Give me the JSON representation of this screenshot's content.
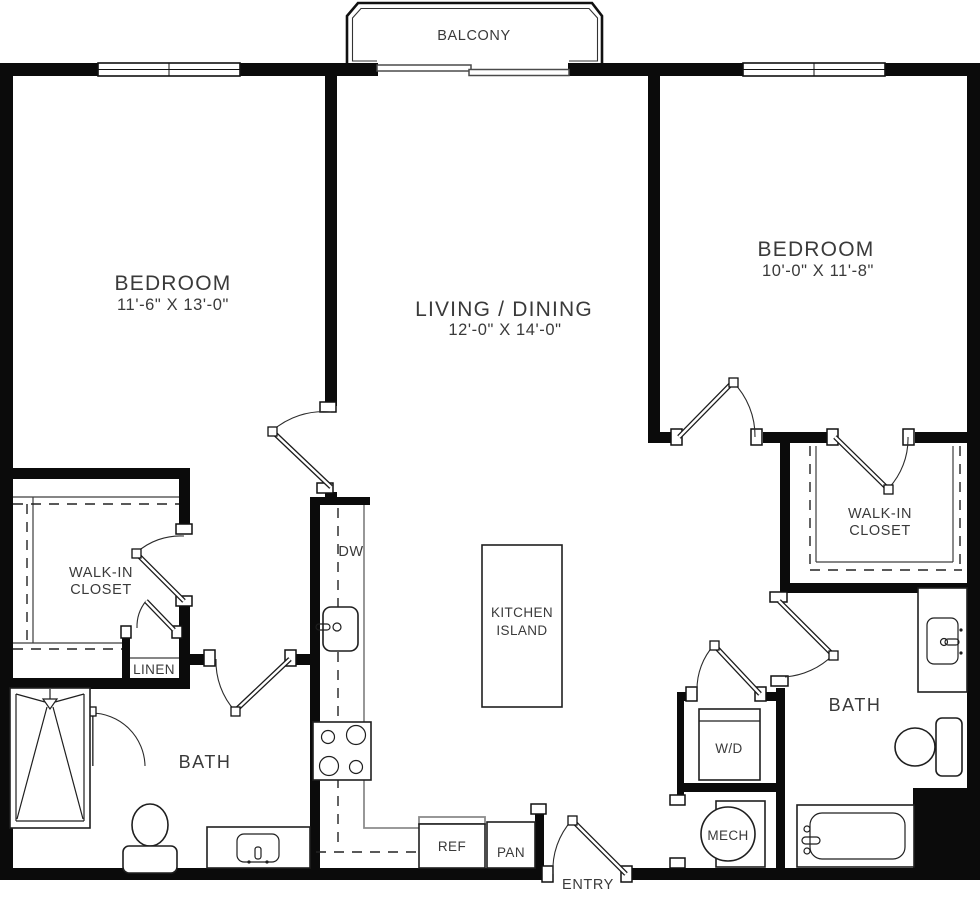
{
  "balcony": {
    "label": "BALCONY"
  },
  "rooms": {
    "bedroom_left": {
      "name": "BEDROOM",
      "dims": "11'-6\" X 13'-0\""
    },
    "living_dining": {
      "name": "LIVING / DINING",
      "dims": "12'-0\" X 14'-0\""
    },
    "bedroom_right": {
      "name": "BEDROOM",
      "dims": "10'-0\" X 11'-8\""
    },
    "walk_in_closet_left": {
      "line1": "WALK-IN",
      "line2": "CLOSET"
    },
    "walk_in_closet_right": {
      "line1": "WALK-IN",
      "line2": "CLOSET"
    },
    "linen": {
      "label": "LINEN"
    },
    "bath_left": {
      "label": "BATH"
    },
    "bath_right": {
      "label": "BATH"
    },
    "entry": {
      "label": "ENTRY"
    }
  },
  "kitchen": {
    "dishwasher_label": "DW",
    "island_label_line1": "KITCHEN",
    "island_label_line2": "ISLAND",
    "refrigerator_label": "REF",
    "pantry_label": "PAN"
  },
  "utility": {
    "washer_dryer_label": "W/D",
    "mechanical_label": "MECH"
  },
  "colors": {
    "wall": "#0b0b0b",
    "text": "#3a3a3a",
    "counter_line": "#8c8c8c",
    "background": "#ffffff"
  }
}
